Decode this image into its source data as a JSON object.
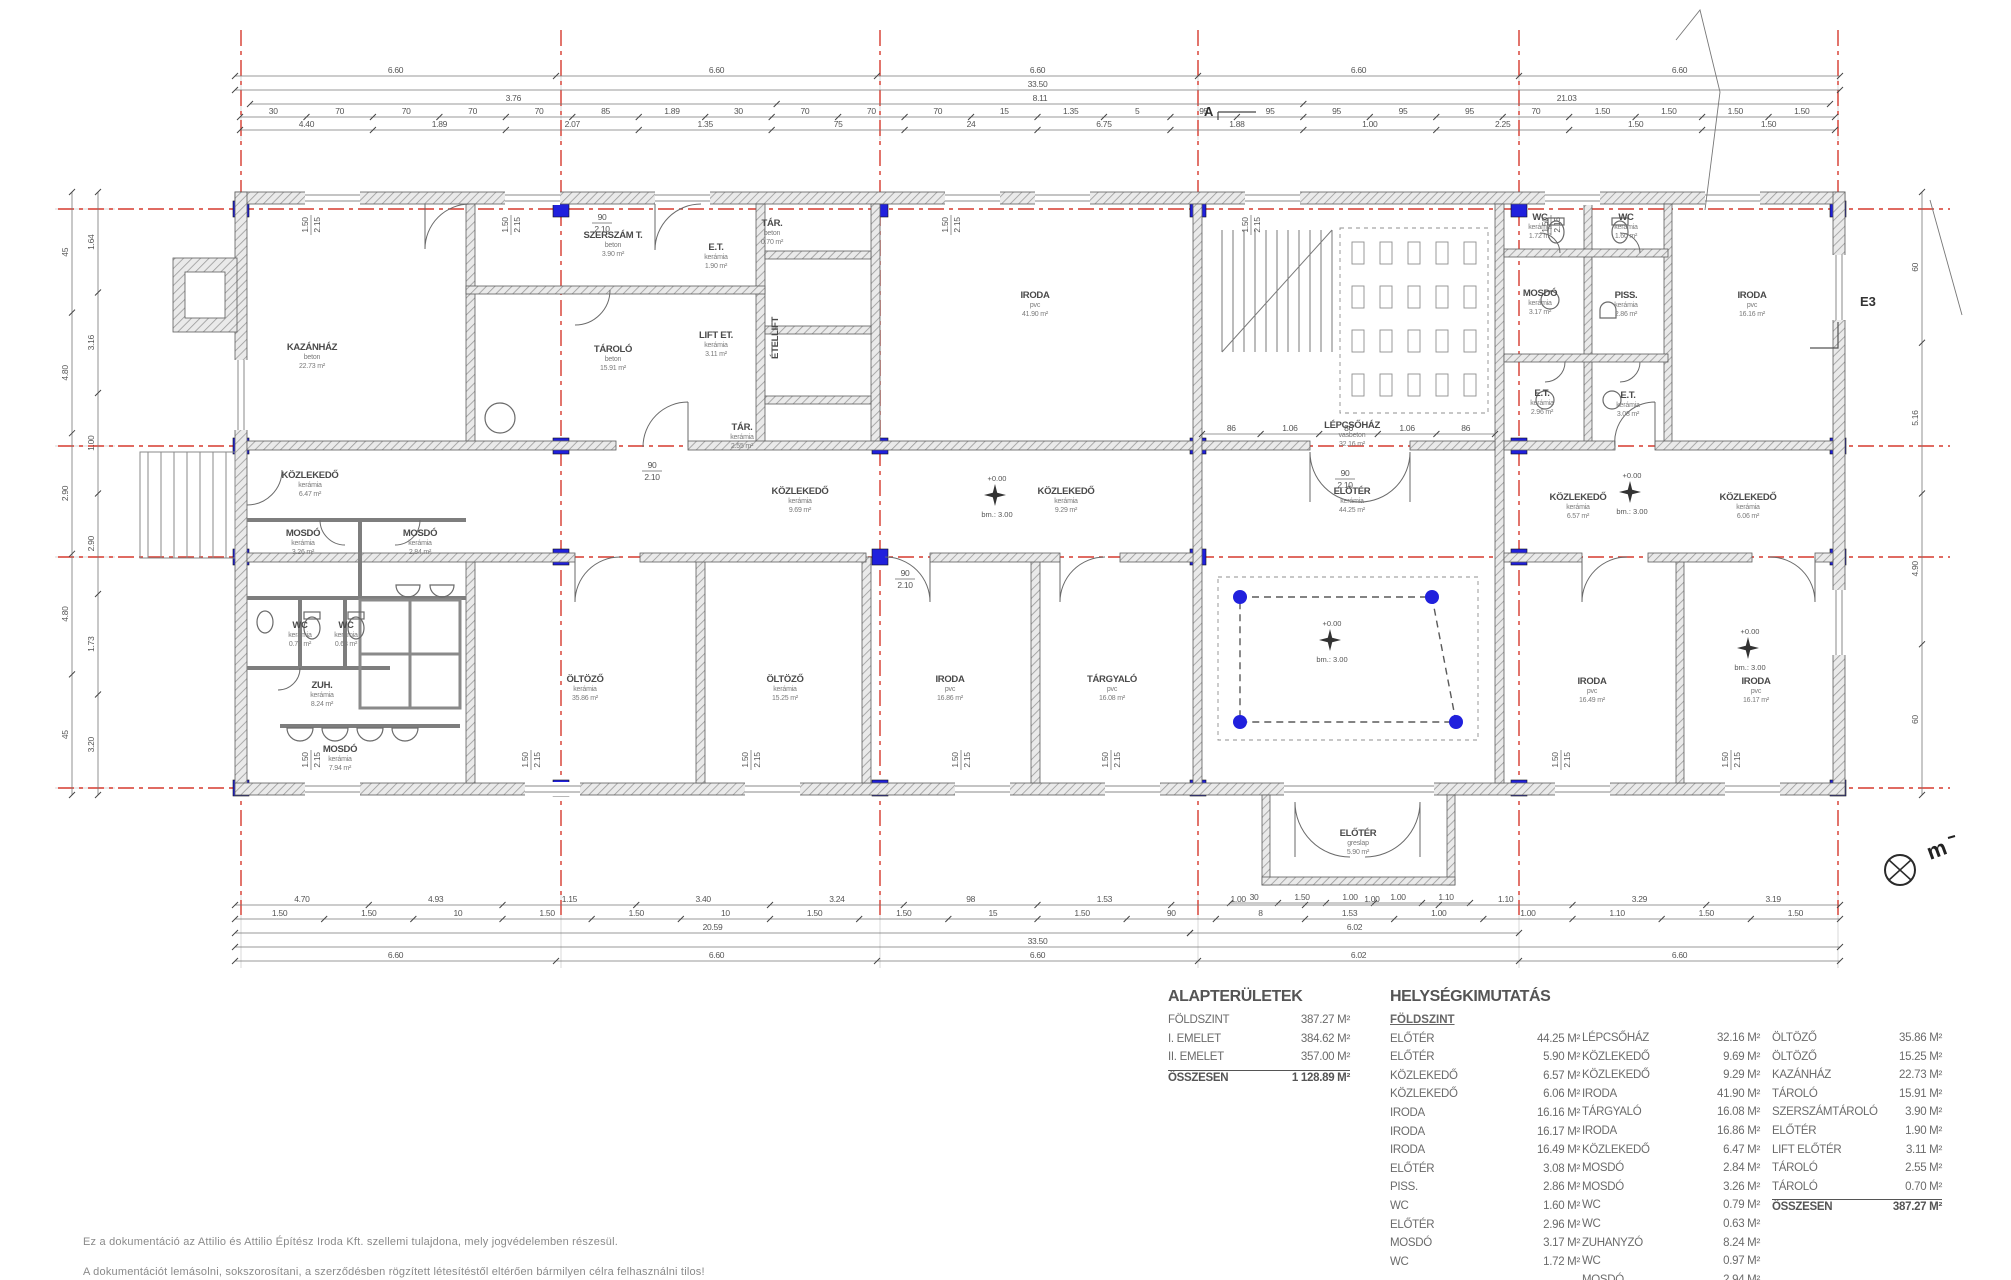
{
  "rooms": [
    {
      "x": 312,
      "y": 350,
      "name": "KAZÁNHÁZ",
      "mat": "beton",
      "area": "22.73 m²"
    },
    {
      "x": 613,
      "y": 238,
      "name": "SZERSZÁM T.",
      "mat": "beton",
      "area": "3.90 m²"
    },
    {
      "x": 716,
      "y": 250,
      "name": "E.T.",
      "mat": "kerámia",
      "area": "1.90 m²"
    },
    {
      "x": 772,
      "y": 226,
      "name": "TÁR.",
      "mat": "beton",
      "area": "0.70 m²"
    },
    {
      "x": 613,
      "y": 352,
      "name": "TÁROLÓ",
      "mat": "beton",
      "area": "15.91 m²"
    },
    {
      "x": 716,
      "y": 338,
      "name": "LIFT ET.",
      "mat": "kerámia",
      "area": "3.11 m²"
    },
    {
      "x": 778,
      "y": 338,
      "name": "ÉTELLIFT",
      "mat": "",
      "area": "",
      "vert": 1
    },
    {
      "x": 742,
      "y": 430,
      "name": "TÁR.",
      "mat": "kerámia",
      "area": "2.55 m²"
    },
    {
      "x": 1035,
      "y": 298,
      "name": "IRODA",
      "mat": "pvc",
      "area": "41.90 m²"
    },
    {
      "x": 1352,
      "y": 428,
      "name": "LÉPCSŐHÁZ",
      "mat": "vasbeton",
      "area": "32.16 m²"
    },
    {
      "x": 1540,
      "y": 220,
      "name": "WC",
      "mat": "kerámia",
      "area": "1.72 m²"
    },
    {
      "x": 1626,
      "y": 220,
      "name": "WC",
      "mat": "kerámia",
      "area": "1.60 m²"
    },
    {
      "x": 1540,
      "y": 296,
      "name": "MOSDÓ",
      "mat": "kerámia",
      "area": "3.17 m²"
    },
    {
      "x": 1626,
      "y": 298,
      "name": "PISS.",
      "mat": "kerámia",
      "area": "2.86 m²"
    },
    {
      "x": 1752,
      "y": 298,
      "name": "IRODA",
      "mat": "pvc",
      "area": "16.16 m²"
    },
    {
      "x": 1542,
      "y": 396,
      "name": "E.T.",
      "mat": "kerámia",
      "area": "2.96 m²"
    },
    {
      "x": 1628,
      "y": 398,
      "name": "E.T.",
      "mat": "kerámia",
      "area": "3.08 m²"
    },
    {
      "x": 310,
      "y": 478,
      "name": "KÖZLEKEDŐ",
      "mat": "kerámia",
      "area": "6.47 m²"
    },
    {
      "x": 303,
      "y": 536,
      "name": "MOSDÓ",
      "mat": "kerámia",
      "area": "3.26 m²"
    },
    {
      "x": 420,
      "y": 536,
      "name": "MOSDÓ",
      "mat": "kerámia",
      "area": "2.84 m²"
    },
    {
      "x": 800,
      "y": 494,
      "name": "KÖZLEKEDŐ",
      "mat": "kerámia",
      "area": "9.69 m²"
    },
    {
      "x": 1066,
      "y": 494,
      "name": "KÖZLEKEDŐ",
      "mat": "kerámia",
      "area": "9.29 m²"
    },
    {
      "x": 1352,
      "y": 494,
      "name": "ELŐTÉR",
      "mat": "kerámia",
      "area": "44.25 m²"
    },
    {
      "x": 1578,
      "y": 500,
      "name": "KÖZLEKEDŐ",
      "mat": "kerámia",
      "area": "6.57 m²"
    },
    {
      "x": 1748,
      "y": 500,
      "name": "KÖZLEKEDŐ",
      "mat": "kerámia",
      "area": "6.06 m²"
    },
    {
      "x": 300,
      "y": 628,
      "name": "WC",
      "mat": "kerámia",
      "area": "0.79 m²"
    },
    {
      "x": 346,
      "y": 628,
      "name": "WC",
      "mat": "kerámia",
      "area": "0.63 m²"
    },
    {
      "x": 322,
      "y": 688,
      "name": "ZUH.",
      "mat": "kerámia",
      "area": "8.24 m²"
    },
    {
      "x": 340,
      "y": 752,
      "name": "MOSDÓ",
      "mat": "kerámia",
      "area": "7.94 m²"
    },
    {
      "x": 585,
      "y": 682,
      "name": "ÖLTÖZŐ",
      "mat": "kerámia",
      "area": "35.86 m²"
    },
    {
      "x": 785,
      "y": 682,
      "name": "ÖLTÖZŐ",
      "mat": "kerámia",
      "area": "15.25 m²"
    },
    {
      "x": 950,
      "y": 682,
      "name": "IRODA",
      "mat": "pvc",
      "area": "16.86 m²"
    },
    {
      "x": 1112,
      "y": 682,
      "name": "TÁRGYALÓ",
      "mat": "pvc",
      "area": "16.08 m²"
    },
    {
      "x": 1592,
      "y": 684,
      "name": "IRODA",
      "mat": "pvc",
      "area": "16.49 m²"
    },
    {
      "x": 1756,
      "y": 684,
      "name": "IRODA",
      "mat": "pvc",
      "area": "16.17 m²"
    },
    {
      "x": 1358,
      "y": 836,
      "name": "ELŐTÉR",
      "mat": "greslap",
      "area": "5.90 m²"
    }
  ],
  "dims": {
    "top_660": [
      "6.60",
      "6.60",
      "6.60",
      "6.60",
      "6.60"
    ],
    "top_total": [
      "33.50"
    ],
    "top_sub1": [
      "3.76",
      "8.11",
      "21.03"
    ],
    "top_small1": [
      "30",
      "70",
      "70",
      "70",
      "70",
      "85",
      "1.89",
      "30",
      "70",
      "70",
      "70",
      "15",
      "1.35",
      "5",
      "95",
      "95",
      "95",
      "95",
      "95",
      "70",
      "1.50",
      "1.50",
      "1.50",
      "1.50"
    ],
    "top_small2": [
      "4.40",
      "1.89",
      "2.07",
      "1.35",
      "75",
      "24",
      "6.75",
      "1.88",
      "1.00",
      "2.25",
      "1.50",
      "1.50"
    ],
    "hall_win": [
      "86",
      "1.06",
      "86",
      "1.06",
      "86"
    ],
    "portico": [
      "30",
      "1.50",
      "1.00",
      "1.00",
      "1.10"
    ],
    "bot_small1": [
      "4.70",
      "4.93",
      "1.15",
      "3.40",
      "3.24",
      "98",
      "1.53",
      "1.00",
      "1.00",
      "1.10",
      "3.29",
      "3.19"
    ],
    "bot_small2": [
      "1.50",
      "1.50",
      "10",
      "1.50",
      "1.50",
      "10",
      "1.50",
      "1.50",
      "15",
      "1.50",
      "90",
      "8",
      "1.53",
      "1.00",
      "1.00",
      "1.10",
      "1.50",
      "1.50"
    ],
    "bot_2059": [
      "20.59"
    ],
    "bot_602": [
      "6.02"
    ],
    "bot_total": [
      "33.50"
    ],
    "bot_660": [
      "6.60",
      "6.60",
      "6.60",
      "6.02",
      "6.60"
    ],
    "left_outer": [
      "45",
      "4.80",
      "2.90",
      "4.80",
      "45"
    ],
    "left_inner": [
      "1.64",
      "3.16",
      "1.00",
      "2.90",
      "1.73",
      "3.20"
    ],
    "right_outer": [
      "60",
      "5.16",
      "4.90",
      "60"
    ]
  },
  "markers": {
    "section": "A",
    "boundary": "E3",
    "bench": "m",
    "elev_zero": "+0.00",
    "elev_bm": "bm.: 3.00",
    "door_w": "90",
    "door_h": "2.10",
    "win_w": "1.50",
    "win_h": "2.15"
  },
  "tables": {
    "alap": {
      "title": "ALAPTERÜLETEK",
      "rows": [
        {
          "n": "FÖLDSZINT",
          "v": "387.27 M²"
        },
        {
          "n": "I. EMELET",
          "v": "384.62 M²"
        },
        {
          "n": "II. EMELET",
          "v": "357.00 M²"
        }
      ],
      "total_n": "ÖSSZESEN",
      "total_v": "1 128.89 M²"
    },
    "hely": {
      "title": "HELYSÉGKIMUTATÁS",
      "floor": "FÖLDSZINT",
      "col1": [
        {
          "n": "ELŐTÉR",
          "v": "44.25 M²"
        },
        {
          "n": "ELŐTÉR",
          "v": "5.90 M²"
        },
        {
          "n": "KÖZLEKEDŐ",
          "v": "6.57 M²"
        },
        {
          "n": "KÖZLEKEDŐ",
          "v": "6.06 M²"
        },
        {
          "n": "IRODA",
          "v": "16.16 M²"
        },
        {
          "n": "IRODA",
          "v": "16.17 M²"
        },
        {
          "n": "IRODA",
          "v": "16.49 M²"
        },
        {
          "n": "ELŐTÉR",
          "v": "3.08 M²"
        },
        {
          "n": "PISS.",
          "v": "2.86 M²"
        },
        {
          "n": "WC",
          "v": "1.60 M²"
        },
        {
          "n": "ELŐTÉR",
          "v": "2.96 M²"
        },
        {
          "n": "MOSDÓ",
          "v": "3.17 M²"
        },
        {
          "n": "WC",
          "v": "1.72 M²"
        }
      ],
      "col2": [
        {
          "n": "LÉPCSŐHÁZ",
          "v": "32.16 M²"
        },
        {
          "n": "KÖZLEKEDŐ",
          "v": "9.69 M²"
        },
        {
          "n": "KÖZLEKEDŐ",
          "v": "9.29 M²"
        },
        {
          "n": "IRODA",
          "v": "41.90 M²"
        },
        {
          "n": "TÁRGYALÓ",
          "v": "16.08 M²"
        },
        {
          "n": "IRODA",
          "v": "16.86 M²"
        },
        {
          "n": "KÖZLEKEDŐ",
          "v": "6.47 M²"
        },
        {
          "n": "MOSDÓ",
          "v": "2.84 M²"
        },
        {
          "n": "MOSDÓ",
          "v": "3.26 M²"
        },
        {
          "n": "WC",
          "v": "0.79 M²"
        },
        {
          "n": "WC",
          "v": "0.63 M²"
        },
        {
          "n": "ZUHANYZÓ",
          "v": "8.24 M²"
        },
        {
          "n": "WC",
          "v": "0.97 M²"
        },
        {
          "n": "MOSDÓ",
          "v": "2.94 M²"
        }
      ],
      "col3": [
        {
          "n": "ÖLTÖZŐ",
          "v": "35.86 M²"
        },
        {
          "n": "ÖLTÖZŐ",
          "v": "15.25 M²"
        },
        {
          "n": "KAZÁNHÁZ",
          "v": "22.73 M²"
        },
        {
          "n": "TÁROLÓ",
          "v": "15.91 M²"
        },
        {
          "n": "SZERSZÁMTÁROLÓ",
          "v": "3.90 M²"
        },
        {
          "n": "ELŐTÉR",
          "v": "1.90 M²"
        },
        {
          "n": "LIFT ELŐTÉR",
          "v": "3.11 M²"
        },
        {
          "n": "TÁROLÓ",
          "v": "2.55 M²"
        },
        {
          "n": "TÁROLÓ",
          "v": "0.70 M²"
        }
      ],
      "total_n": "ÖSSZESEN",
      "total_v": "387.27 M²"
    }
  },
  "footer": {
    "line1": "Ez a dokumentáció az Attilio és Attilio Építész Iroda Kft. szellemi tulajdona, mely jogvédelemben részesül.",
    "line2": "A dokumentációt lemásolni, sokszorosítani, a szerződésben rögzített létesítéstől eltérően bármilyen célra felhasználni tilos!"
  }
}
